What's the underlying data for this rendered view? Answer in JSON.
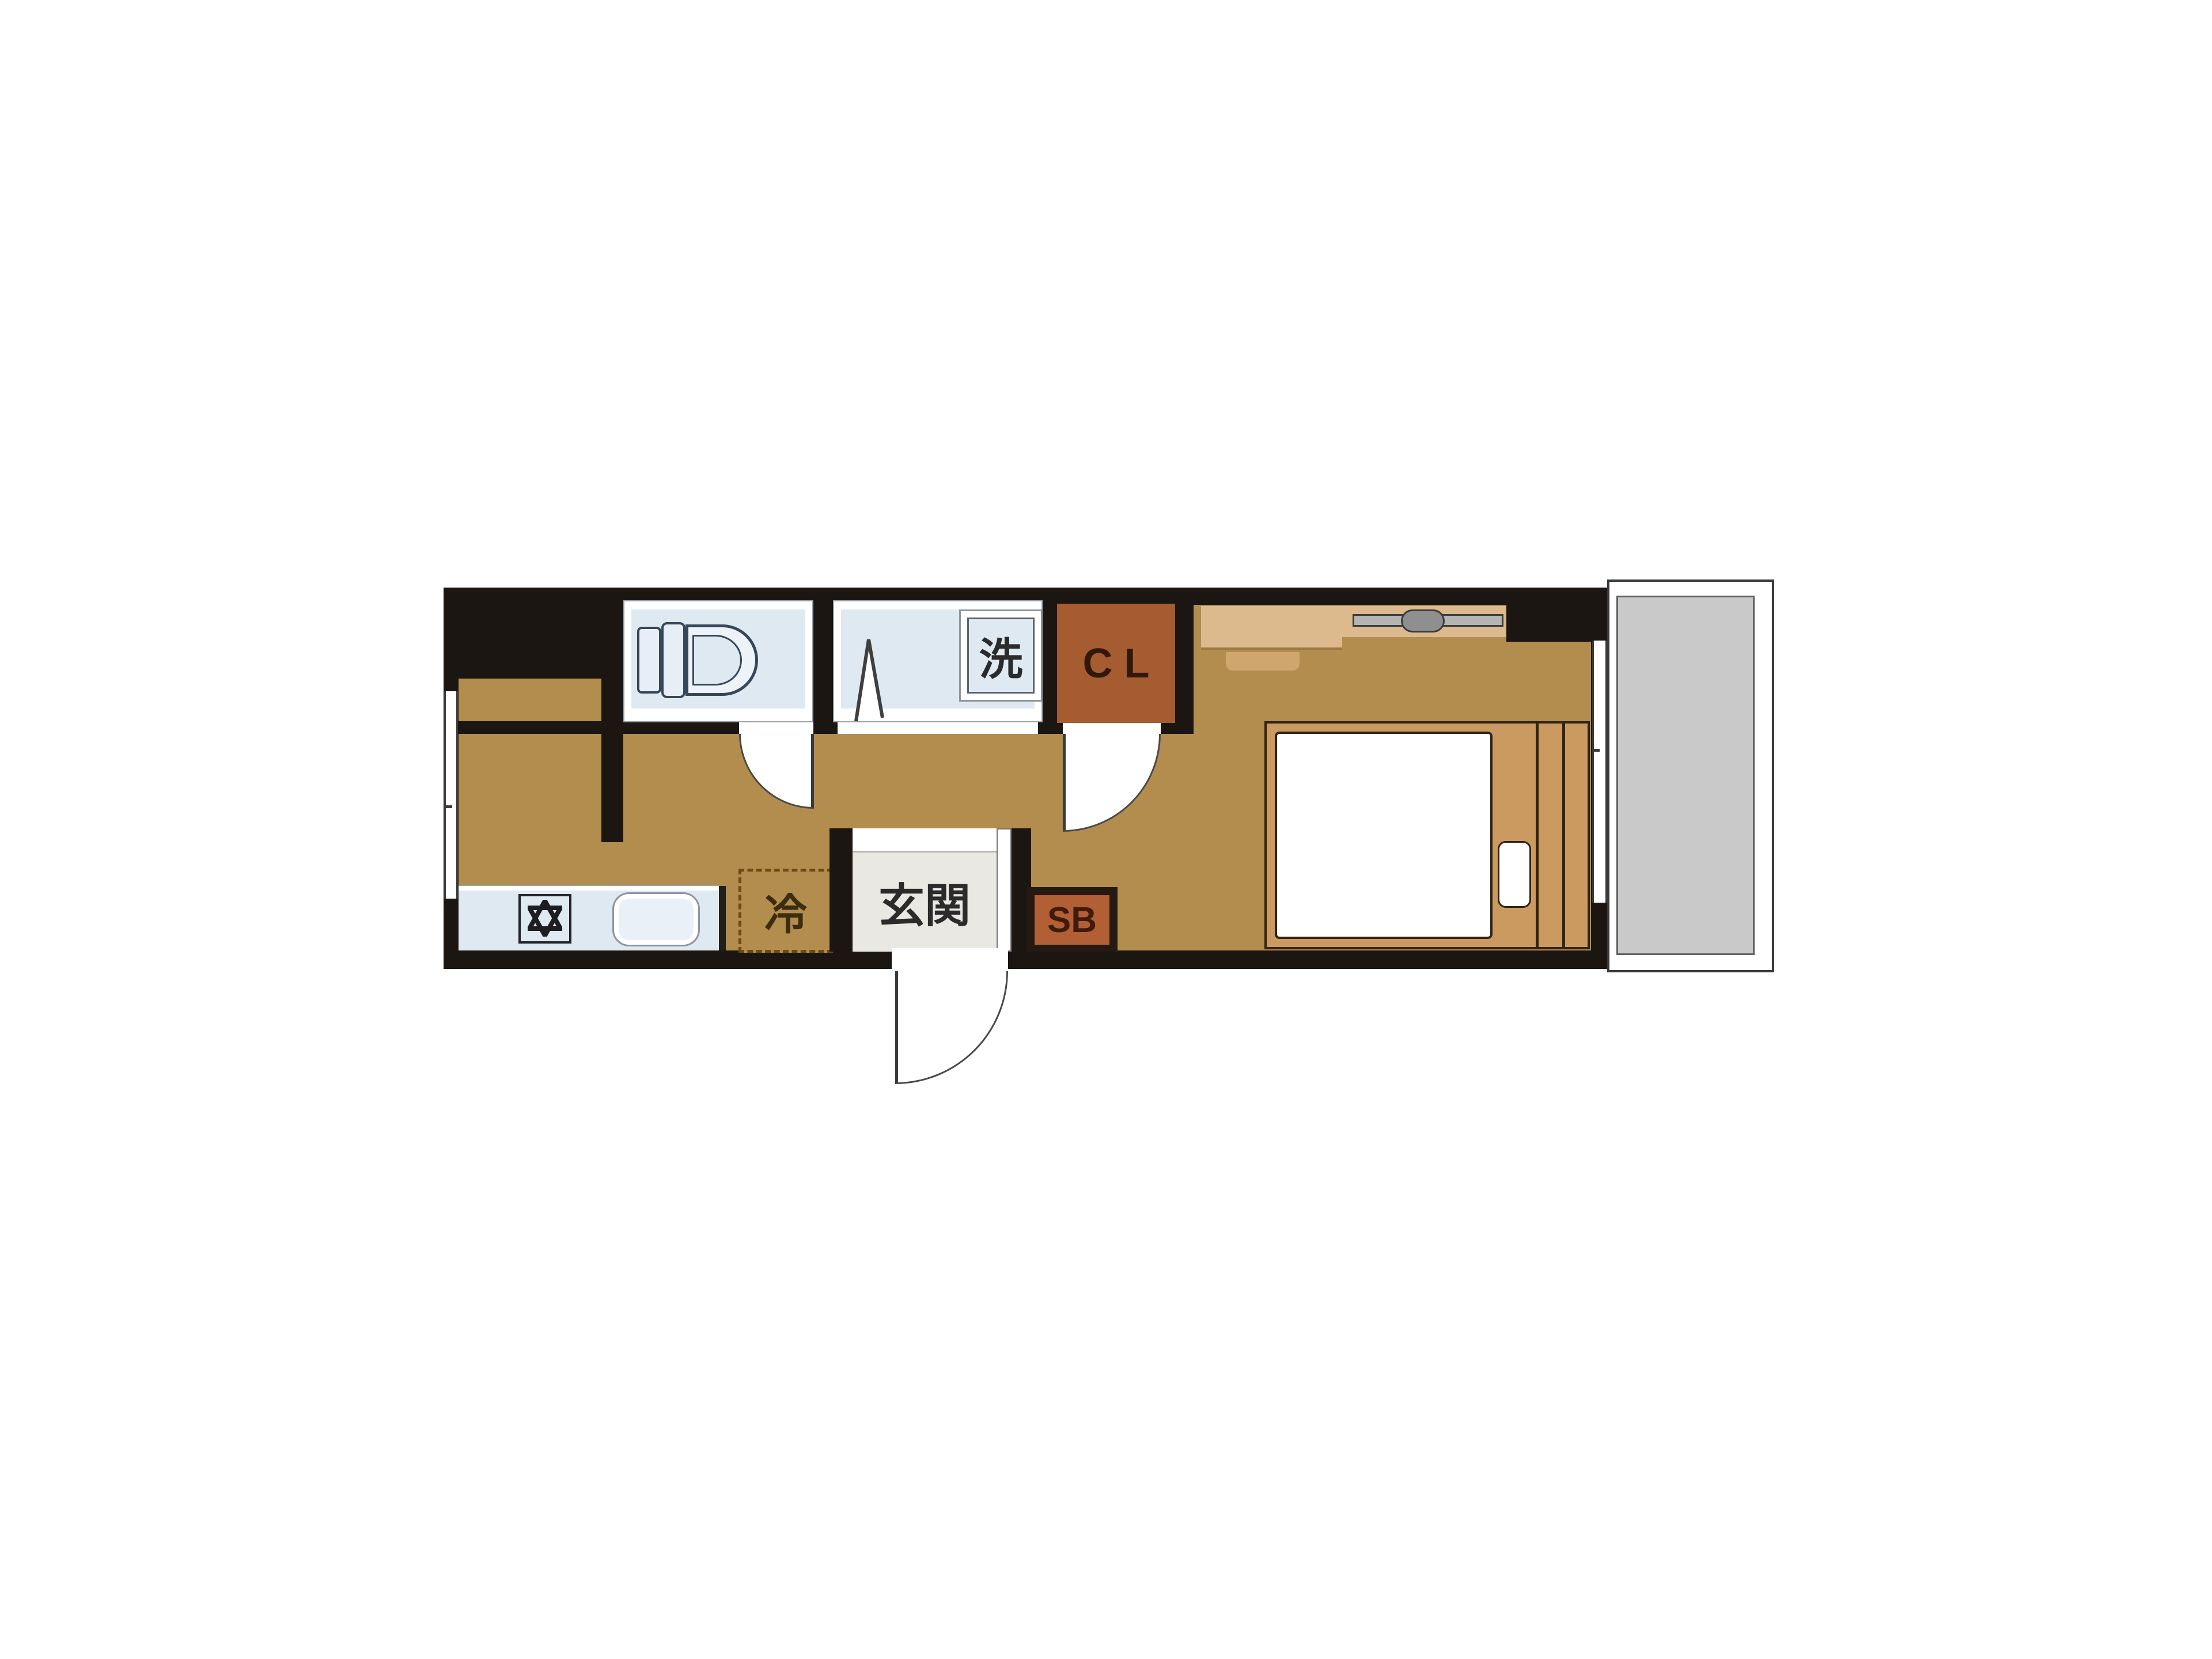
{
  "document": {
    "type": "Japanese studio apartment floor plan (madori)"
  },
  "labels": {
    "washing_machine": "洗",
    "closet": "CL",
    "refrigerator": "冷",
    "entrance": "玄関",
    "shoe_box": "SB"
  },
  "icons": {
    "toilet": "toilet-icon (tank + seat + bowl, plan view)",
    "stove": "stove-burner-icon (hexagram star in square)",
    "sink": "sink-icon (rounded rectangle)",
    "folding_door": "folding-door-icon (inverted V)",
    "swing_door": "quarter-circle door swing",
    "bed": "single-bed-icon (mattress + pillow + footboard slats)",
    "hanger_rail": "hanger-rail-icon (grey bar with slider)",
    "window": "double-line window symbol"
  },
  "colors": {
    "background": "#ffffff",
    "wall": "#1b1612",
    "floor": "#b28d4e",
    "wet_room": "#dfe9f2",
    "fixture_outline": "#37475a",
    "closet": "#a55c30",
    "closet_text": "#31180a",
    "shoe_box": "#b35f36",
    "shoe_box_frame": "#241a12",
    "entrance_floor": "#eae8e3",
    "counter_tan": "#dcba8e",
    "bed_frame": "#cb9a60",
    "balcony": "#c9c9c9",
    "label_text": "#2b2b2b",
    "dashed": "#6b4a14"
  }
}
